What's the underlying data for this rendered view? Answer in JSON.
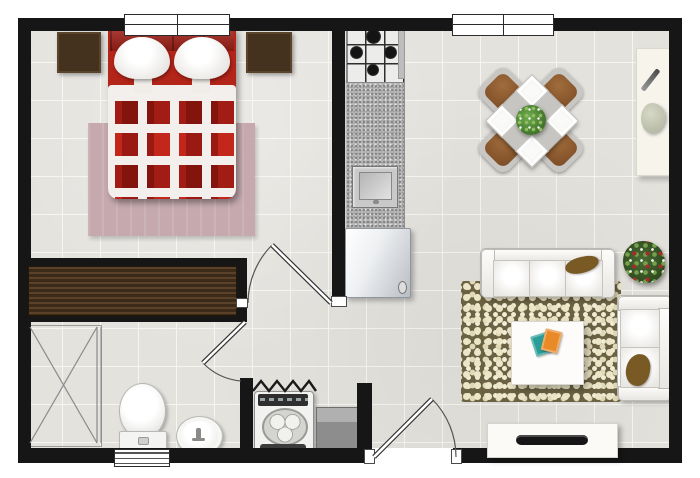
{
  "meta": {
    "title": "Studio apartment floor plan (top-down view)",
    "type": "floor-plan",
    "visible_text": []
  },
  "palette": {
    "wall": "#161616",
    "floor": "#e4e2dd",
    "grout": "#f6f5f1",
    "bed-red": "#c3271c",
    "bed-dark": "#9e1f16",
    "rug-bedroom": "#c3a4ab",
    "rug-living-bg": "#6b6243",
    "rug-living-dot": "#ece5c8",
    "chair-brown": "#7a4a24",
    "table-gray": "#c6c5c1",
    "plant-green": "#2e5a1f",
    "berry-red": "#a62c2c",
    "blanket-brown": "#7a5a24"
  },
  "rooms": [
    {
      "name": "bedroom",
      "furniture": [
        "double bed with red checkered duvet",
        "left nightstand",
        "right nightstand",
        "mauve area rug",
        "built-in wardrobe",
        "window"
      ]
    },
    {
      "name": "bathroom",
      "furniture": [
        "shower enclosure",
        "toilet",
        "pedestal sink",
        "louvered window",
        "swing door"
      ]
    },
    {
      "name": "kitchen",
      "furniture": [
        "gas stove (4 burners)",
        "granite counter",
        "kitchen sink",
        "refrigerator"
      ]
    },
    {
      "name": "laundry-nook",
      "furniture": [
        "top-load washing machine",
        "gray cabinet",
        "zigzag partition"
      ]
    },
    {
      "name": "dining-area",
      "furniture": [
        "square table rotated 45°",
        "4 brown chairs",
        "4 place settings",
        "green centerpiece plant",
        "wall console with decor"
      ]
    },
    {
      "name": "living-area",
      "furniture": [
        "three-seat sofa with brown throw",
        "two-seat loveseat with brown throw",
        "pebble-textured rug",
        "white coffee table with books",
        "TV stand with television",
        "corner plant with red berries"
      ]
    },
    {
      "name": "hall",
      "furniture": [
        "bedroom swing door",
        "entry swing door"
      ]
    }
  ],
  "titles": {
    "plan": "Studio apartment floor plan",
    "bed": "Double bed",
    "nightstand_left": "Nightstand",
    "nightstand_right": "Nightstand",
    "wardrobe": "Wardrobe",
    "bedroom_rug": "Bedroom rug",
    "shower": "Shower",
    "toilet": "Toilet",
    "bath_sink": "Pedestal sink",
    "washer": "Washing machine",
    "cabinet": "Cabinet",
    "stove": "Gas stove",
    "counter": "Kitchen counter",
    "kitchen_sink": "Kitchen sink",
    "fridge": "Refrigerator",
    "dining_set": "Dining table for four",
    "console": "Console table",
    "sofa": "Three-seat sofa",
    "loveseat": "Loveseat",
    "coffee_table": "Coffee table",
    "living_rug": "Pebble rug",
    "tv_stand": "TV stand",
    "plant": "Plant"
  }
}
